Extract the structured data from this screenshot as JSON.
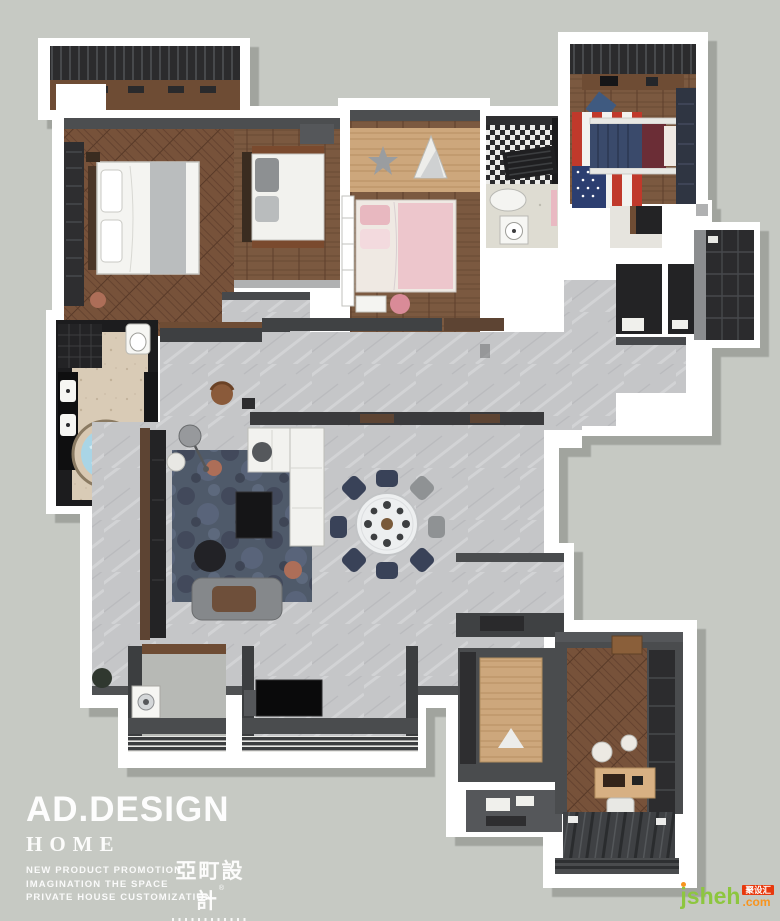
{
  "page": {
    "background": "#c6c9c3"
  },
  "brand": {
    "name": "AD.DESIGN",
    "line2": "HOME",
    "taglines": [
      "NEW PRODUCT PROMOTION",
      "IMAGINATION THE SPACE",
      "PRIVATE HOUSE CUSTOMIZATION"
    ],
    "logo_cn": "亞町設計",
    "logo_reg": "®",
    "text_color": "#ffffff"
  },
  "watermark": {
    "site_name": "jsheh",
    "site_tld": ".com",
    "badge": "聚设汇",
    "name_color": "#8dc63f",
    "tld_color": "#f7941e",
    "badge_bg": "#e8380d"
  },
  "floorplan": {
    "style": "3d-top-down-apartment-rendering",
    "palette": {
      "wall": "#ffffff",
      "wall_shadow": "#9fa29c",
      "wood_dark": "#7b5940",
      "wood_light": "#cda77c",
      "tile_gray_marble": "#c6c7c9",
      "tile_beige": "#d9cbb6",
      "charcoal_cabinet": "#2e2e30",
      "brown_cabinet": "#6e4c34",
      "sofa_white": "#f2f2ef",
      "rug_blue_gray": "#4f5a6a",
      "dining_chair_navy": "#394258",
      "bed_pink": "#edc6cc",
      "tub_water_blue": "#a9d5e6",
      "flag_red": "#c0392b",
      "flag_blue": "#2c3e70"
    }
  }
}
